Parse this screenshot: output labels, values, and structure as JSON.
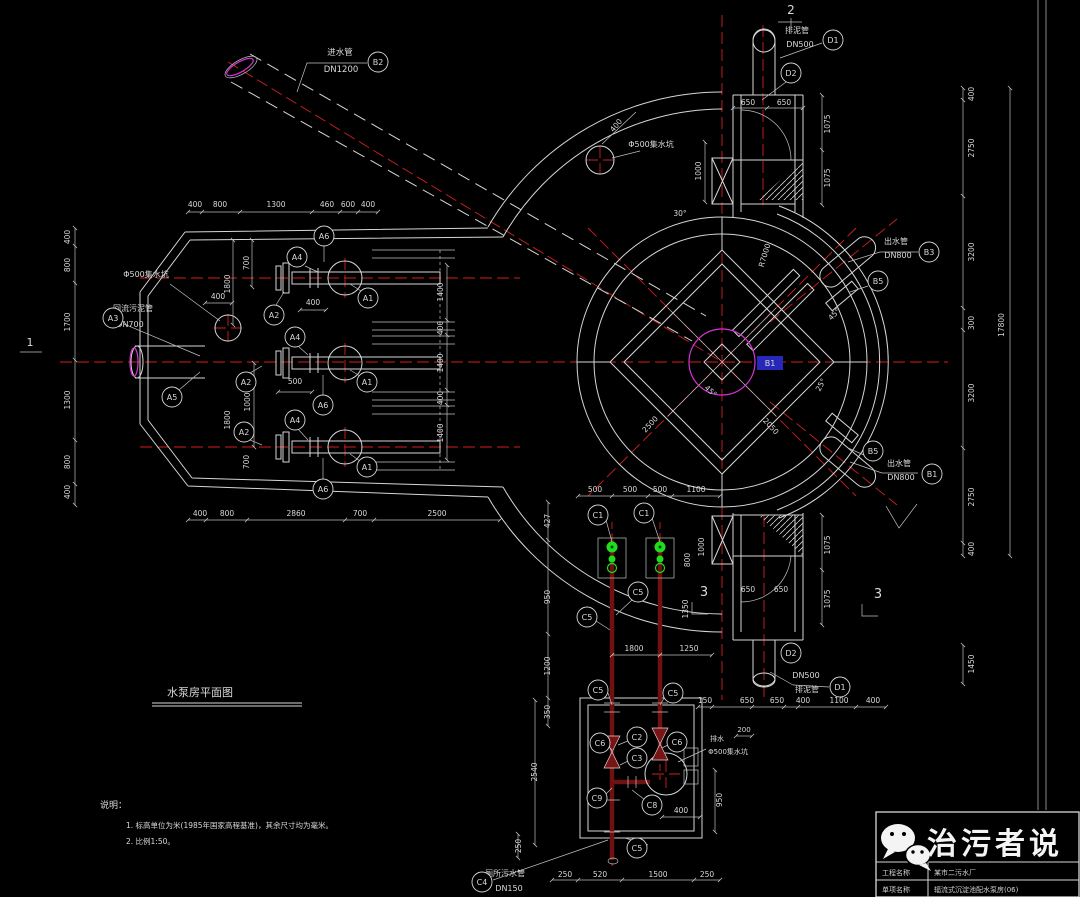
{
  "meta": {
    "bg": "#000000",
    "text_color": "#d9d9d9",
    "line_color": "#d6d6d6",
    "red": "#cf2020",
    "dark_red": "#6e1111",
    "green": "#1ddf1d",
    "magenta": "#d633d6",
    "highlight": "#2727b8"
  },
  "title": {
    "text": "水泵房平面图"
  },
  "notes": {
    "heading": "说明：",
    "item1": "1. 标高单位为米(1985年国家高程基准)，其余尺寸均为毫米。",
    "item2": "2. 比例1:50。"
  },
  "watermark": {
    "text": "治污者说",
    "icon": "wechat-logo"
  },
  "titleblock": {
    "row1_label": "工程名称",
    "row1_value": "某市二污水厂",
    "row2_label": "单项名称",
    "row2_value": "辐流式沉淀池配水泵房(06)"
  },
  "annotations": {
    "balloons": [
      {
        "x": 378,
        "y": 62,
        "t": "B2"
      },
      {
        "x": 833,
        "y": 40,
        "t": "D1"
      },
      {
        "x": 791,
        "y": 73,
        "t": "D2"
      },
      {
        "x": 929,
        "y": 252,
        "t": "B3"
      },
      {
        "x": 878,
        "y": 281,
        "t": "B5"
      },
      {
        "x": 873,
        "y": 451,
        "t": "B5"
      },
      {
        "x": 932,
        "y": 474,
        "t": "B1"
      },
      {
        "x": 113,
        "y": 318,
        "t": "A3"
      },
      {
        "x": 172,
        "y": 397,
        "t": "A5"
      },
      {
        "x": 324,
        "y": 236,
        "t": "A6"
      },
      {
        "x": 297,
        "y": 257,
        "t": "A4"
      },
      {
        "x": 274,
        "y": 315,
        "t": "A2"
      },
      {
        "x": 368,
        "y": 298,
        "t": "A1"
      },
      {
        "x": 295,
        "y": 337,
        "t": "A4"
      },
      {
        "x": 246,
        "y": 382,
        "t": "A2"
      },
      {
        "x": 367,
        "y": 382,
        "t": "A1"
      },
      {
        "x": 323,
        "y": 405,
        "t": "A6"
      },
      {
        "x": 295,
        "y": 420,
        "t": "A4"
      },
      {
        "x": 244,
        "y": 432,
        "t": "A2"
      },
      {
        "x": 367,
        "y": 467,
        "t": "A1"
      },
      {
        "x": 323,
        "y": 489,
        "t": "A6"
      },
      {
        "x": 598,
        "y": 515,
        "t": "C1"
      },
      {
        "x": 644,
        "y": 513,
        "t": "C1"
      },
      {
        "x": 638,
        "y": 592,
        "t": "C5"
      },
      {
        "x": 587,
        "y": 617,
        "t": "C5"
      },
      {
        "x": 598,
        "y": 690,
        "t": "C5"
      },
      {
        "x": 673,
        "y": 693,
        "t": "C5"
      },
      {
        "x": 637,
        "y": 737,
        "t": "C2"
      },
      {
        "x": 600,
        "y": 743,
        "t": "C6"
      },
      {
        "x": 677,
        "y": 742,
        "t": "C6"
      },
      {
        "x": 637,
        "y": 758,
        "t": "C3"
      },
      {
        "x": 597,
        "y": 798,
        "t": "C9"
      },
      {
        "x": 652,
        "y": 805,
        "t": "C8"
      },
      {
        "x": 637,
        "y": 848,
        "t": "C5"
      },
      {
        "x": 482,
        "y": 882,
        "t": "C4"
      },
      {
        "x": 840,
        "y": 687,
        "t": "D1"
      },
      {
        "x": 791,
        "y": 653,
        "t": "D2"
      }
    ],
    "texts": [
      {
        "x": 340,
        "y": 55,
        "t": "进水管",
        "s": 8.5,
        "n": "pipe-label"
      },
      {
        "x": 341,
        "y": 72,
        "t": "DN1200",
        "s": 8.5,
        "n": "pipe-label"
      },
      {
        "x": 797,
        "y": 33,
        "t": "排泥管",
        "s": 8,
        "n": "pipe-label"
      },
      {
        "x": 800,
        "y": 47,
        "t": "DN500",
        "s": 8,
        "n": "pipe-label"
      },
      {
        "x": 651,
        "y": 147,
        "t": "Φ500集水坑",
        "s": 8,
        "n": "sump-label"
      },
      {
        "x": 618,
        "y": 127,
        "t": "400",
        "r": -50
      },
      {
        "x": 146,
        "y": 277,
        "t": "Φ500集水坑",
        "s": 8,
        "n": "sump-label"
      },
      {
        "x": 218,
        "y": 299,
        "t": "400"
      },
      {
        "x": 133,
        "y": 311,
        "t": "回流污泥管",
        "s": 8,
        "n": "pipe-label"
      },
      {
        "x": 130,
        "y": 327,
        "t": "DN700",
        "s": 8,
        "n": "pipe-label"
      },
      {
        "x": 896,
        "y": 244,
        "t": "出水管",
        "s": 8,
        "n": "pipe-label"
      },
      {
        "x": 898,
        "y": 258,
        "t": "DN800",
        "s": 8,
        "n": "pipe-label"
      },
      {
        "x": 899,
        "y": 466,
        "t": "出水管",
        "s": 8,
        "n": "pipe-label"
      },
      {
        "x": 901,
        "y": 480,
        "t": "DN800",
        "s": 8,
        "n": "pipe-label"
      },
      {
        "x": 806,
        "y": 678,
        "t": "DN500",
        "s": 8,
        "n": "pipe-label"
      },
      {
        "x": 807,
        "y": 692,
        "t": "排泥管",
        "s": 8,
        "n": "pipe-label"
      },
      {
        "x": 717,
        "y": 741,
        "t": "排水",
        "s": 7,
        "n": "sump-label"
      },
      {
        "x": 728,
        "y": 754,
        "t": "Φ500集水坑",
        "s": 7,
        "n": "sump-label"
      },
      {
        "x": 505,
        "y": 876,
        "t": "厕所污水管",
        "s": 8,
        "n": "pipe-label"
      },
      {
        "x": 509,
        "y": 891,
        "t": "DN150",
        "s": 8,
        "n": "pipe-label"
      },
      {
        "x": 680,
        "y": 216,
        "t": "30°"
      },
      {
        "x": 767,
        "y": 256,
        "t": "R7000",
        "r": -73
      },
      {
        "x": 836,
        "y": 316,
        "t": "45°",
        "r": -45
      },
      {
        "x": 709,
        "y": 393,
        "t": "45°",
        "r": 42
      },
      {
        "x": 823,
        "y": 386,
        "t": "25°",
        "r": -62
      },
      {
        "x": 652,
        "y": 426,
        "t": "2500",
        "r": -47
      },
      {
        "x": 769,
        "y": 428,
        "t": "2050",
        "r": 47
      },
      {
        "x": 195,
        "y": 207,
        "t": "400"
      },
      {
        "x": 220,
        "y": 207,
        "t": "800"
      },
      {
        "x": 276,
        "y": 207,
        "t": "1300"
      },
      {
        "x": 327,
        "y": 207,
        "t": "460"
      },
      {
        "x": 348,
        "y": 207,
        "t": "600"
      },
      {
        "x": 368,
        "y": 207,
        "t": "400"
      },
      {
        "x": 70,
        "y": 237,
        "t": "400",
        "r": -90
      },
      {
        "x": 70,
        "y": 265,
        "t": "800",
        "r": -90
      },
      {
        "x": 70,
        "y": 322,
        "t": "1700",
        "r": -90
      },
      {
        "x": 70,
        "y": 400,
        "t": "1300",
        "r": -90
      },
      {
        "x": 70,
        "y": 462,
        "t": "800",
        "r": -90
      },
      {
        "x": 70,
        "y": 492,
        "t": "400",
        "r": -90
      },
      {
        "x": 200,
        "y": 516,
        "t": "400"
      },
      {
        "x": 227,
        "y": 516,
        "t": "800"
      },
      {
        "x": 296,
        "y": 516,
        "t": "2860"
      },
      {
        "x": 360,
        "y": 516,
        "t": "700"
      },
      {
        "x": 437,
        "y": 516,
        "t": "2500"
      },
      {
        "x": 443,
        "y": 292,
        "t": "1400",
        "r": -90
      },
      {
        "x": 443,
        "y": 328,
        "t": "400",
        "r": -90
      },
      {
        "x": 443,
        "y": 363,
        "t": "1400",
        "r": -90
      },
      {
        "x": 443,
        "y": 398,
        "t": "400",
        "r": -90
      },
      {
        "x": 443,
        "y": 433,
        "t": "1400",
        "r": -90
      },
      {
        "x": 249,
        "y": 263,
        "t": "700",
        "r": -90
      },
      {
        "x": 230,
        "y": 284,
        "t": "1800",
        "r": -90
      },
      {
        "x": 313,
        "y": 305,
        "t": "400"
      },
      {
        "x": 295,
        "y": 384,
        "t": "500"
      },
      {
        "x": 250,
        "y": 402,
        "t": "1000",
        "r": -90
      },
      {
        "x": 249,
        "y": 462,
        "t": "700",
        "r": -90
      },
      {
        "x": 230,
        "y": 420,
        "t": "1800",
        "r": -90
      },
      {
        "x": 748,
        "y": 105,
        "t": "650"
      },
      {
        "x": 784,
        "y": 105,
        "t": "650"
      },
      {
        "x": 830,
        "y": 124,
        "t": "1075",
        "r": -90
      },
      {
        "x": 830,
        "y": 178,
        "t": "1075",
        "r": -90
      },
      {
        "x": 701,
        "y": 171,
        "t": "1000",
        "r": -90
      },
      {
        "x": 748,
        "y": 592,
        "t": "650"
      },
      {
        "x": 781,
        "y": 592,
        "t": "650"
      },
      {
        "x": 830,
        "y": 545,
        "t": "1075",
        "r": -90
      },
      {
        "x": 830,
        "y": 599,
        "t": "1075",
        "r": -90
      },
      {
        "x": 705,
        "y": 703,
        "t": "150"
      },
      {
        "x": 747,
        "y": 703,
        "t": "650"
      },
      {
        "x": 777,
        "y": 703,
        "t": "650"
      },
      {
        "x": 803,
        "y": 703,
        "t": "400"
      },
      {
        "x": 839,
        "y": 703,
        "t": "1100"
      },
      {
        "x": 873,
        "y": 703,
        "t": "400"
      },
      {
        "x": 974,
        "y": 94,
        "t": "400",
        "r": -90
      },
      {
        "x": 974,
        "y": 148,
        "t": "2750",
        "r": -90
      },
      {
        "x": 974,
        "y": 252,
        "t": "3200",
        "r": -90
      },
      {
        "x": 974,
        "y": 323,
        "t": "300",
        "r": -90
      },
      {
        "x": 974,
        "y": 393,
        "t": "3200",
        "r": -90
      },
      {
        "x": 974,
        "y": 497,
        "t": "2750",
        "r": -90
      },
      {
        "x": 974,
        "y": 549,
        "t": "400",
        "r": -90
      },
      {
        "x": 974,
        "y": 664,
        "t": "1450",
        "r": -90
      },
      {
        "x": 1004,
        "y": 325,
        "t": "17800",
        "r": -90
      },
      {
        "x": 595,
        "y": 492,
        "t": "500"
      },
      {
        "x": 630,
        "y": 492,
        "t": "500"
      },
      {
        "x": 660,
        "y": 492,
        "t": "500"
      },
      {
        "x": 696,
        "y": 492,
        "t": "1100"
      },
      {
        "x": 704,
        "y": 547,
        "t": "1000",
        "r": -90
      },
      {
        "x": 690,
        "y": 560,
        "t": "800",
        "r": -90
      },
      {
        "x": 688,
        "y": 609,
        "t": "1350",
        "r": -90
      },
      {
        "x": 634,
        "y": 651,
        "t": "1800"
      },
      {
        "x": 689,
        "y": 651,
        "t": "1250"
      },
      {
        "x": 550,
        "y": 521,
        "t": "427",
        "r": -90
      },
      {
        "x": 550,
        "y": 597,
        "t": "950",
        "r": -90
      },
      {
        "x": 550,
        "y": 666,
        "t": "1200",
        "r": -90
      },
      {
        "x": 550,
        "y": 712,
        "t": "350",
        "r": -90
      },
      {
        "x": 537,
        "y": 772,
        "t": "2540",
        "r": -90
      },
      {
        "x": 521,
        "y": 846,
        "t": "250",
        "r": -90
      },
      {
        "x": 681,
        "y": 813,
        "t": "400"
      },
      {
        "x": 722,
        "y": 800,
        "t": "950",
        "r": -90
      },
      {
        "x": 744,
        "y": 732,
        "t": "200",
        "s": 7
      },
      {
        "x": 565,
        "y": 877,
        "t": "250"
      },
      {
        "x": 600,
        "y": 877,
        "t": "520"
      },
      {
        "x": 658,
        "y": 877,
        "t": "1500"
      },
      {
        "x": 707,
        "y": 877,
        "t": "250"
      },
      {
        "x": 791,
        "y": 14,
        "t": "2",
        "s": 12,
        "n": "section-marker"
      },
      {
        "x": 704,
        "y": 596,
        "t": "3",
        "s": 13,
        "n": "section-marker"
      },
      {
        "x": 878,
        "y": 598,
        "t": "3",
        "s": 13,
        "n": "section-marker"
      },
      {
        "x": 30,
        "y": 346,
        "t": "1",
        "s": 11,
        "n": "section-marker"
      },
      {
        "x": 770,
        "y": 366,
        "t": "B1",
        "s": 8,
        "c": "#9fb0ff",
        "bg": 1,
        "n": "selected-label-b1"
      }
    ]
  }
}
